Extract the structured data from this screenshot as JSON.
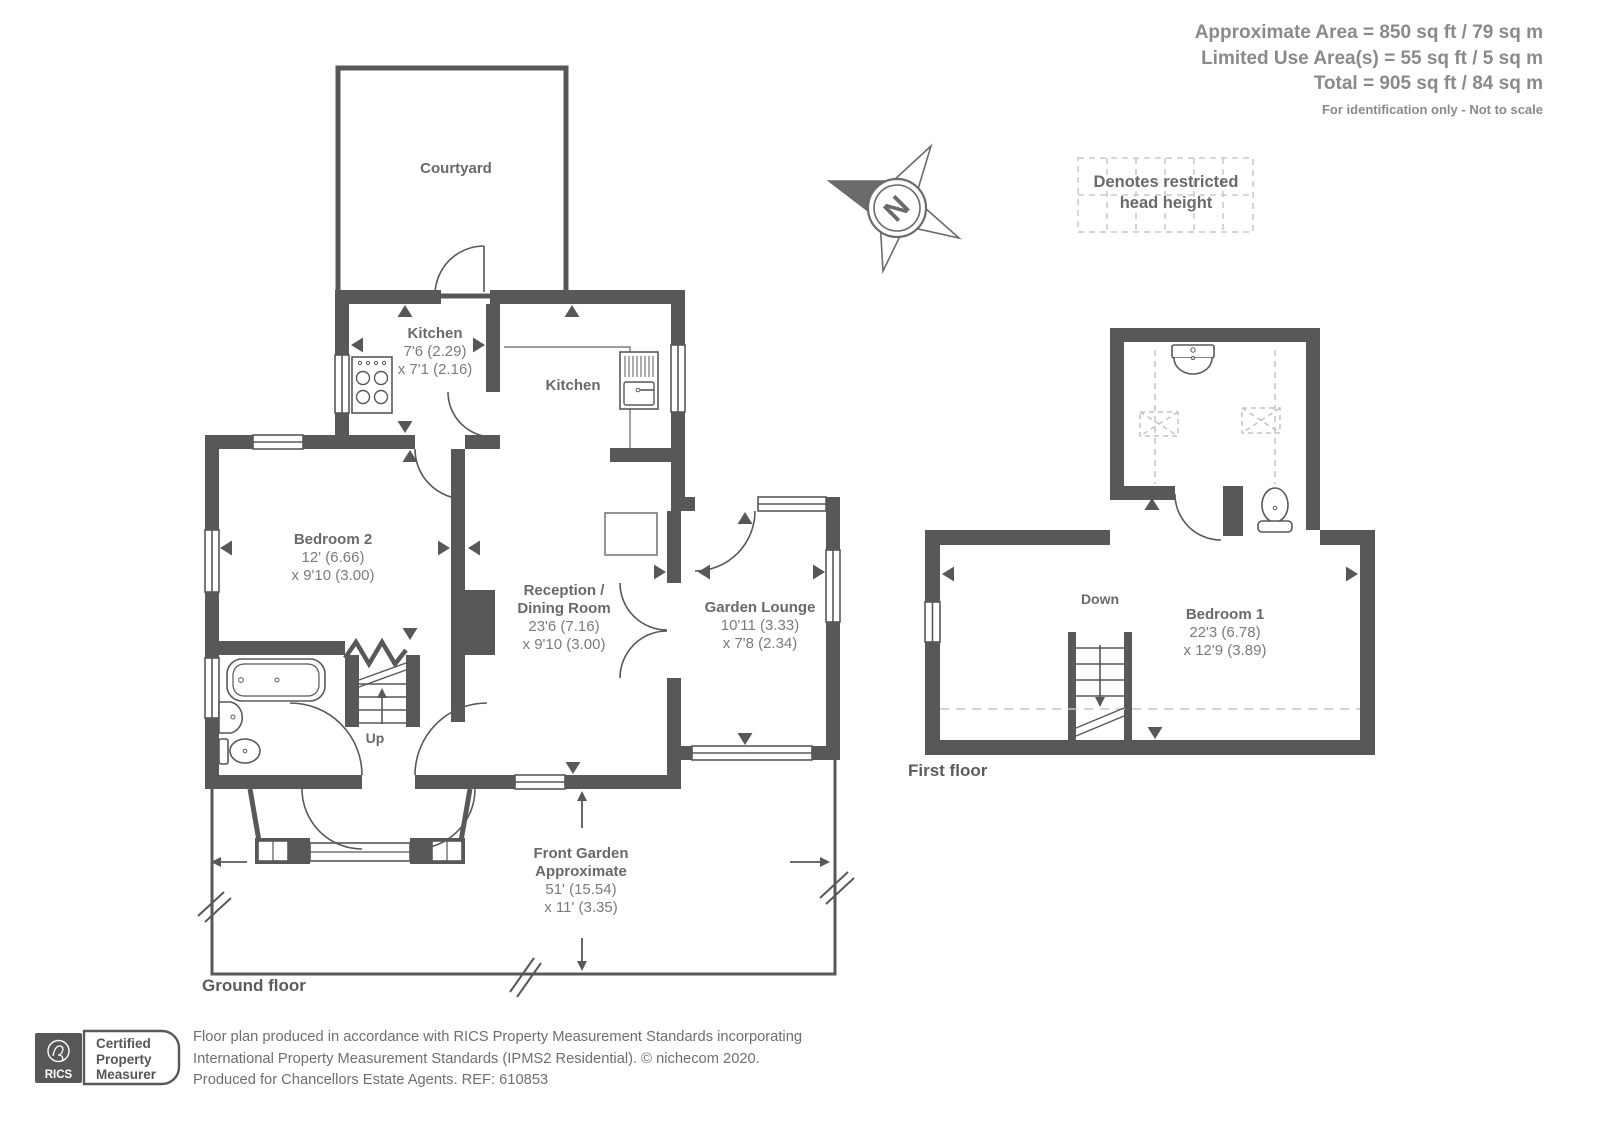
{
  "header": {
    "line1": "Approximate Area = 850 sq ft / 79 sq m",
    "line2": "Limited Use Area(s) = 55 sq ft / 5 sq m",
    "line3": "Total = 905 sq ft / 84 sq m",
    "disclaimer": "For identification only - Not to scale"
  },
  "legend": {
    "line1": "Denotes restricted",
    "line2": "head height"
  },
  "compass": {
    "north": "N"
  },
  "ground_floor": {
    "title": "Ground floor",
    "courtyard": {
      "name": "Courtyard"
    },
    "kitchen_small": {
      "name": "Kitchen",
      "dim1": "7'6 (2.29)",
      "dim2": "x 7'1 (2.16)"
    },
    "kitchen_main": {
      "name": "Kitchen"
    },
    "bedroom2": {
      "name": "Bedroom 2",
      "dim1": "12' (6.66)",
      "dim2": "x 9'10 (3.00)"
    },
    "reception": {
      "name1": "Reception /",
      "name2": "Dining Room",
      "dim1": "23'6 (7.16)",
      "dim2": "x 9'10 (3.00)"
    },
    "garden_lounge": {
      "name": "Garden Lounge",
      "dim1": "10'11 (3.33)",
      "dim2": "x 7'8 (2.34)"
    },
    "front_garden": {
      "name1": "Front Garden",
      "name2": "Approximate",
      "dim1": "51' (15.54)",
      "dim2": "x 11' (3.35)"
    },
    "stairs": "Up"
  },
  "first_floor": {
    "title": "First floor",
    "bedroom1": {
      "name": "Bedroom 1",
      "dim1": "22'3 (6.78)",
      "dim2": "x 12'9 (3.89)"
    },
    "stairs": "Down"
  },
  "footer": {
    "rics": "RICS",
    "badge1": "Certified",
    "badge2": "Property",
    "badge3": "Measurer",
    "text1": "Floor plan produced in accordance with RICS Property Measurement Standards incorporating",
    "text2": "International Property Measurement Standards (IPMS2 Residential).   © nichecom 2020.",
    "text3": "Produced for Chancellors Estate Agents.   REF: 610853"
  },
  "colors": {
    "wall": "#58585b",
    "room_name": "#696969",
    "dim_text": "#7b7b7b",
    "area_text": "#8a8a8a",
    "dashed": "#c4c4c4"
  }
}
